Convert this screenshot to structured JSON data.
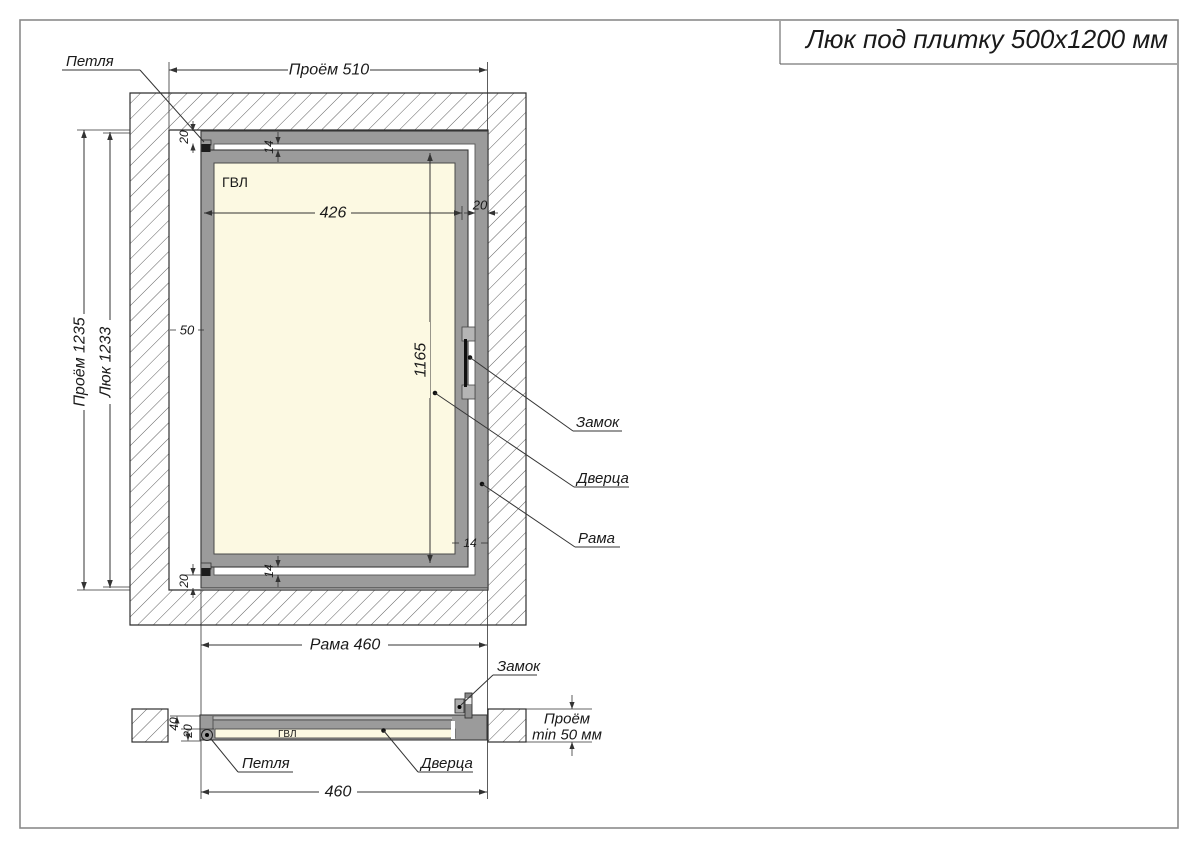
{
  "title": "Люк под плитку 500х1200 мм",
  "front_view": {
    "labels": {
      "hinge": "Петля",
      "lock": "Замок",
      "door": "Дверца",
      "frame": "Рама",
      "panel": "ГВЛ"
    },
    "dims": {
      "opening_width": "Проём 510",
      "opening_height": "Проём 1235",
      "hatch_height": "Люк 1233",
      "frame_width": "Рама 460",
      "panel_width": "426",
      "panel_height": "1165",
      "side_gap": "50",
      "profile_top": "20",
      "profile_right": "20",
      "profile_bottom": "20",
      "gap_top": "14",
      "gap_right": "14",
      "gap_bottom": "14"
    }
  },
  "section_view": {
    "labels": {
      "lock": "Замок",
      "hinge": "Петля",
      "door": "Дверца",
      "panel": "ГВЛ"
    },
    "dims": {
      "depth_total": "40",
      "depth_door": "20",
      "frame_width": "460",
      "opening_depth_line1": "Проём",
      "opening_depth_line2": "min 50 мм"
    }
  },
  "colors": {
    "frame_gray": "#9b9b9b",
    "panel_cream": "#fcf9e2",
    "line": "#333333",
    "sheet_border": "#8a8a8a"
  }
}
